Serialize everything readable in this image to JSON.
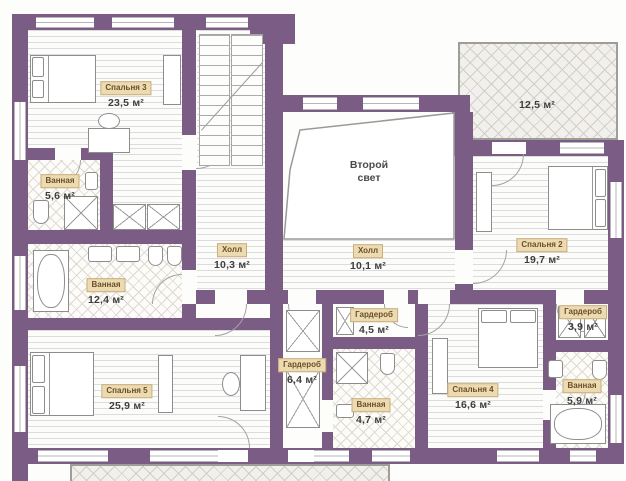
{
  "plan": {
    "type": "floor-plan",
    "language": "ru",
    "colors": {
      "wall": "#7b5c85",
      "room_badge_bg": "#ecdbb1",
      "room_badge_border": "#c9ae7d",
      "room_badge_text": "#6b4e27",
      "area_text": "#3e3e3e"
    },
    "rooms": [
      {
        "id": "bedroom-3",
        "name": "Спальня 3",
        "area": "23,5 м²"
      },
      {
        "id": "bathroom-upper",
        "name": "Ванная",
        "area": "5,6 м²"
      },
      {
        "id": "hall-west",
        "name": "Холл",
        "area": "10,3 м²"
      },
      {
        "id": "second-light",
        "name": "Второй свет",
        "area": ""
      },
      {
        "id": "hall-east",
        "name": "Холл",
        "area": "10,1 м²"
      },
      {
        "id": "terrace",
        "name": "",
        "area": "12,5 м²"
      },
      {
        "id": "bedroom-2",
        "name": "Спальня 2",
        "area": "19,7 м²"
      },
      {
        "id": "bathroom-master",
        "name": "Ванная",
        "area": "12,4 м²"
      },
      {
        "id": "bedroom-5",
        "name": "Спальня 5",
        "area": "25,9 м²"
      },
      {
        "id": "wardrobe-west",
        "name": "Гардероб",
        "area": "6,4 м²"
      },
      {
        "id": "wardrobe-mid",
        "name": "Гардероб",
        "area": "4,5 м²"
      },
      {
        "id": "bathroom-mid",
        "name": "Ванная",
        "area": "4,7 м²"
      },
      {
        "id": "bedroom-4",
        "name": "Спальня 4",
        "area": "16,6 м²"
      },
      {
        "id": "wardrobe-east",
        "name": "Гардероб",
        "area": "3,9 м²"
      },
      {
        "id": "bathroom-east",
        "name": "Ванная",
        "area": "5,9 м²"
      }
    ]
  }
}
